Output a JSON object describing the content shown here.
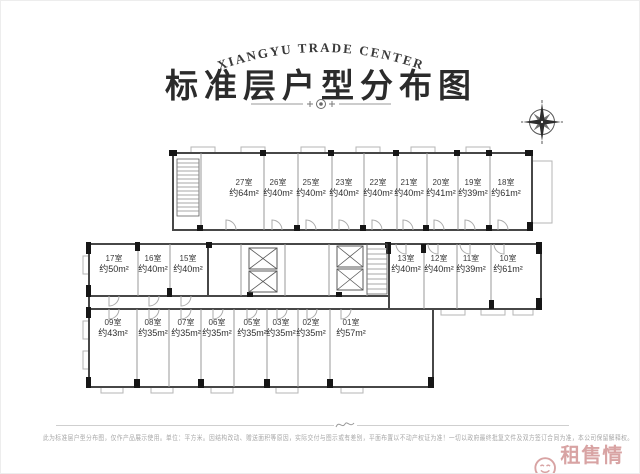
{
  "header": {
    "brand": "XIANGYU TRADE CENTER",
    "title": "标准层户型分布图"
  },
  "plan": {
    "rooms": [
      {
        "no": "27室",
        "area": "约64m²"
      },
      {
        "no": "26室",
        "area": "约40m²"
      },
      {
        "no": "25室",
        "area": "约40m²"
      },
      {
        "no": "23室",
        "area": "约40m²"
      },
      {
        "no": "22室",
        "area": "约40m²"
      },
      {
        "no": "21室",
        "area": "约40m²"
      },
      {
        "no": "20室",
        "area": "约41m²"
      },
      {
        "no": "19室",
        "area": "约39m²"
      },
      {
        "no": "18室",
        "area": "约61m²"
      },
      {
        "no": "17室",
        "area": "约50m²"
      },
      {
        "no": "16室",
        "area": "约40m²"
      },
      {
        "no": "15室",
        "area": "约40m²"
      },
      {
        "no": "13室",
        "area": "约40m²"
      },
      {
        "no": "12室",
        "area": "约40m²"
      },
      {
        "no": "11室",
        "area": "约39m²"
      },
      {
        "no": "10室",
        "area": "约61m²"
      },
      {
        "no": "09室",
        "area": "约43m²"
      },
      {
        "no": "08室",
        "area": "约35m²"
      },
      {
        "no": "07室",
        "area": "约35m²"
      },
      {
        "no": "06室",
        "area": "约35m²"
      },
      {
        "no": "05室",
        "area": "约35m²"
      },
      {
        "no": "03室",
        "area": "约35m²"
      },
      {
        "no": "02室",
        "area": "约35m²"
      },
      {
        "no": "01室",
        "area": "约57m²"
      }
    ]
  },
  "footer": {
    "disclaimer": "此为标准层户型分布图，仅作产品展示使用。单位：平方米。因结构改动、赠送面积等原因，实际交付与图示或有差别，平面布置以不动产权证为准！一切以政府最终批复文件及双方签订合同为准，本公司保留解释权。",
    "watermark": "租售情报"
  },
  "colors": {
    "ink": "#2b2b2b",
    "wall": "#474747",
    "watermark_red": "#d8a3a3"
  }
}
